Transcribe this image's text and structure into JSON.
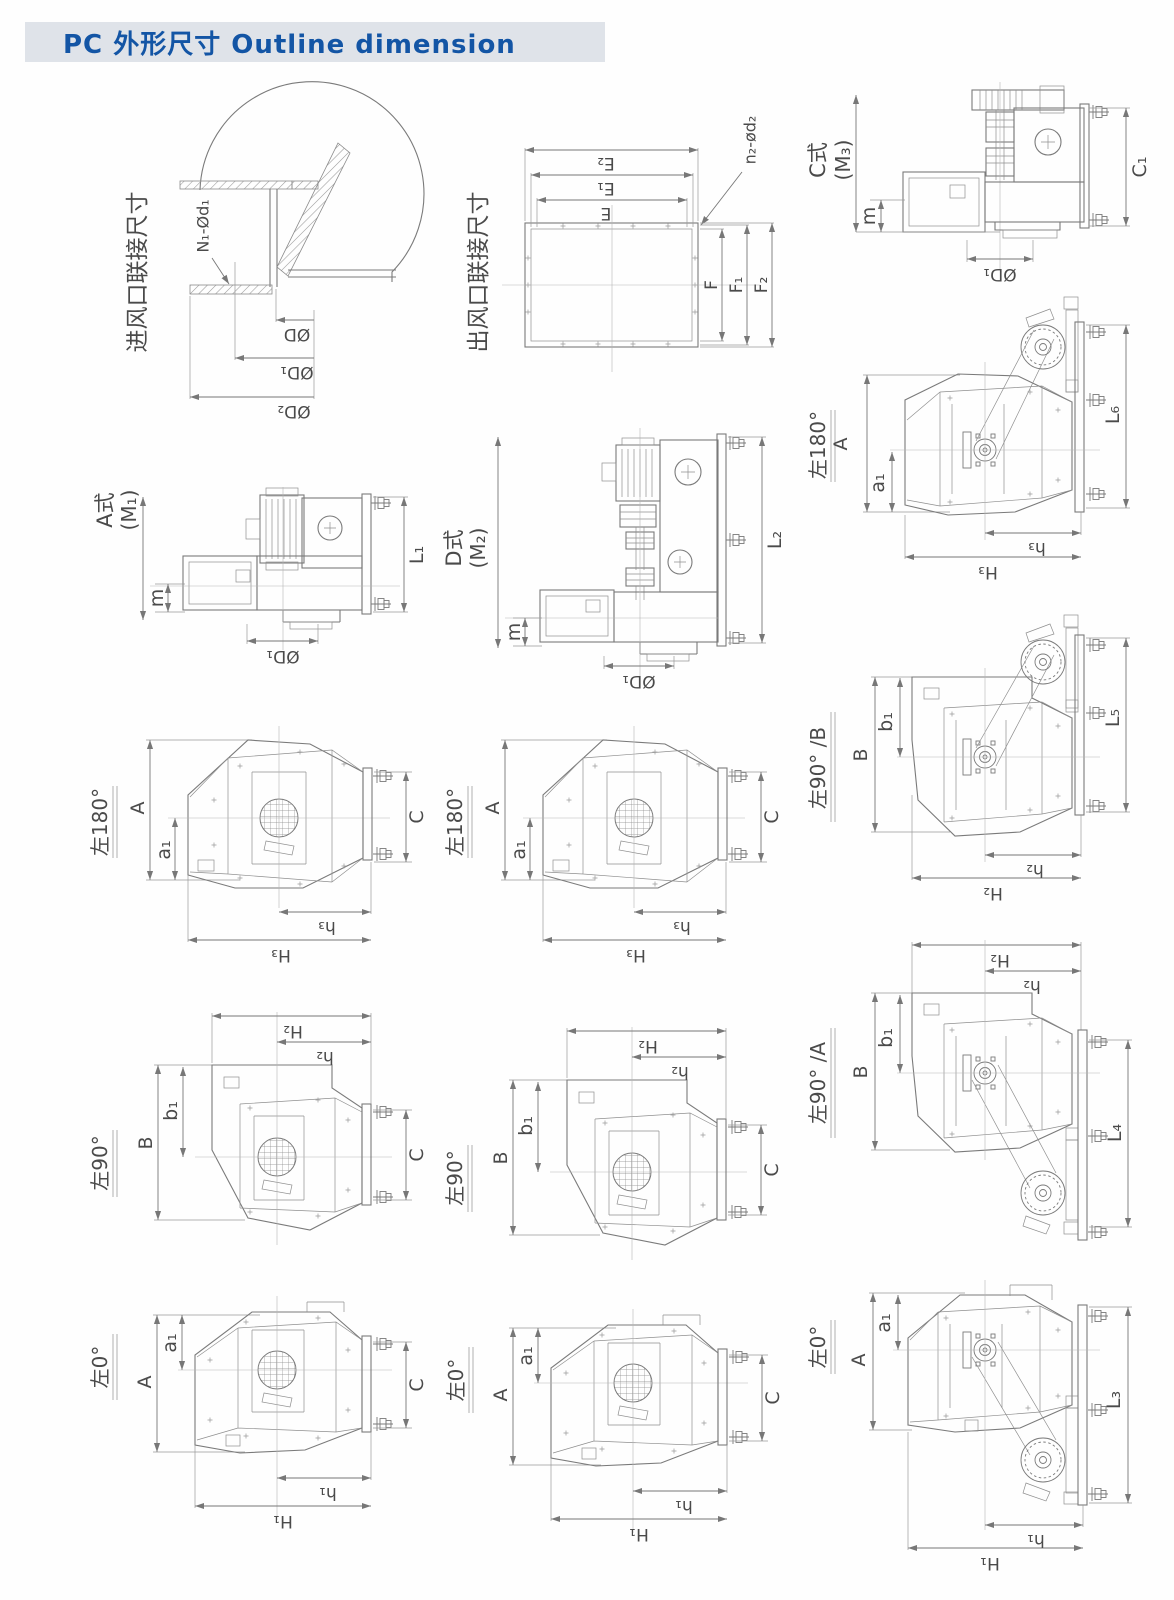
{
  "header": {
    "title": "PC 外形尺寸  Outline dimension"
  },
  "colors": {
    "header_bg": "#dfe3e9",
    "header_text": "#1355a5",
    "line": "#7a7a7a",
    "label": "#4a4a4a",
    "page_bg": "#fefefe"
  },
  "titles": {
    "inlet": "进风口联接尺寸",
    "outlet": "出风口联接尺寸",
    "typeA": "A式",
    "typeA_sub": "(M₁)",
    "typeD": "D式",
    "typeD_sub": "(M₂)",
    "typeC": "C式",
    "typeC_sub": "(M₃)",
    "l180": "左180°",
    "l90": "左90°",
    "l0": "左0°",
    "l90B": "左90° /B",
    "l90A": "左90° /A"
  },
  "dims": {
    "A": "A",
    "a1": "a₁",
    "B": "B",
    "b1": "b₁",
    "C": "C",
    "C1": "C₁",
    "m": "m",
    "D": "ØD",
    "D1": "ØD₁",
    "D2": "ØD₂",
    "N1d1": "N₁-Ød₁",
    "n2d2": "n₂-ød₂",
    "E": "E",
    "E1": "E₁",
    "E2": "E₂",
    "F": "F",
    "F1": "F₁",
    "F2": "F₂",
    "L1": "L₁",
    "L2": "L₂",
    "L3": "L₃",
    "L4": "L₄",
    "L5": "L₅",
    "L6": "L₆",
    "h1": "h₁",
    "H1": "H₁",
    "h2": "h₂",
    "H2": "H₂",
    "h3": "h₃",
    "H3": "H₃"
  }
}
